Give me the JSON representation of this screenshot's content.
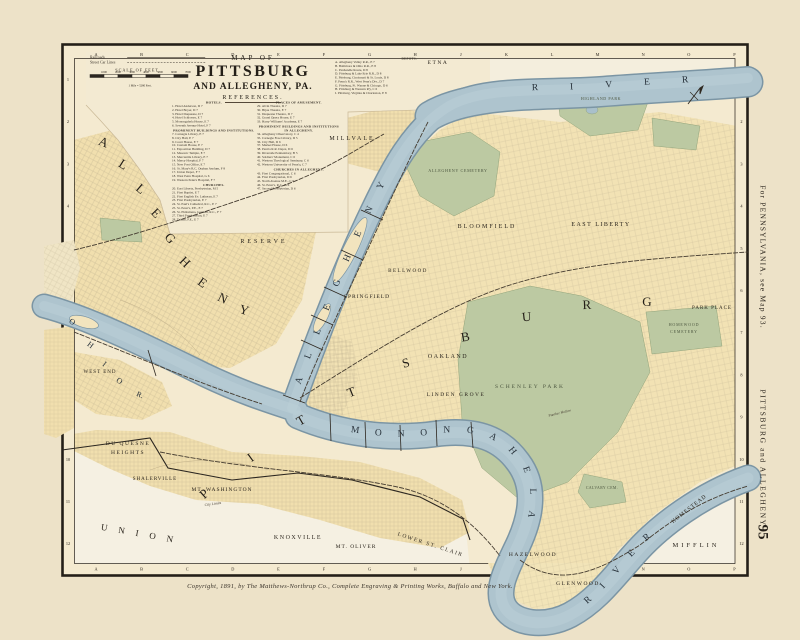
{
  "page": {
    "number": "95",
    "side_note_top": "For PENNSYLVANIA, see Map 93.",
    "side_note_bottom": "PITTSBURG and ALLEGHENY",
    "copyright": "Copyright, 1891, by The Matthews-Northrup Co., Complete Engraving & Printing Works, Buffalo and New York."
  },
  "title": {
    "line1": "MAP OF",
    "line2": "PITTSBURG",
    "line3": "AND ALLEGHENY, PA.",
    "line4": "REFERENCES."
  },
  "legend": {
    "railroads": "Railroads",
    "street_car_lines": "Street Car Lines",
    "scale_title": "SCALE OF FEET.",
    "scale_note": "1 Mile = 5280 Feet.",
    "scale_ticks": [
      "1000",
      "2000",
      "3000",
      "4000",
      "5000",
      "6000",
      "7000"
    ]
  },
  "grid": {
    "columns": [
      "A",
      "B",
      "C",
      "D",
      "E",
      "F",
      "G",
      "H",
      "J",
      "K",
      "L",
      "M",
      "N",
      "O",
      "P"
    ],
    "rows": [
      "1",
      "2",
      "3",
      "4",
      "5",
      "6",
      "7",
      "8",
      "9",
      "10",
      "11",
      "12"
    ]
  },
  "rivers": {
    "allegheny": "ALLEGHENY",
    "allegheny_river": "RIVER",
    "monongahela": "MONONGAHELA",
    "monongahela_river": "RIVER"
  },
  "references": {
    "hotels": {
      "header": "HOTELS.",
      "items": [
        "1. Hotel Anderson, D 7",
        "2. Hotel Boyer, D 7",
        "3. Hotel Duquesne, D 7",
        "4. Hotel Schlosser, E 7",
        "5. Monongahela House, E 7",
        "6. Seventh Avenue Hotel, F 7"
      ]
    },
    "prominent": {
      "header": "PROMINENT BUILDINGS AND INSTITUTIONS.",
      "items": [
        "7. Carnegie Library, E 7",
        "8. City Hall, E 7",
        "9. Court House, E 7",
        "10. Custom House, E 7",
        "11. Exposition Building, D 7",
        "12. Masonic Temple, E 7",
        "13. Mercantile Library, E 7",
        "14. Mercy Hospital, F 7",
        "15. New Post Office, E 7",
        "16. St. Mary's R.C. Orphan Asylum, F 8",
        "17. Union Depot, F 7",
        "18. West Penn Hospital, G 6",
        "19. Western Penn'a Hospital, F 7"
      ]
    },
    "churches": {
      "header": "CHURCHES.",
      "items": [
        "20. East Liberty, Presbyterian, M 5",
        "21. First Baptist, E 7",
        "22. First English Ev. Lutheran, E 7",
        "23. First Presbyterian, E 7",
        "24. St. Paul's Cathedral, R.C., E 7",
        "25. St. Peter's, P.E., E 7",
        "26. St. Philomena, German, R.C., F 7",
        "27. Third Presbyterian, E 7",
        "28. Trinity, P.E., E 7"
      ]
    },
    "amusement": {
      "header": "PLACES OF AMUSEMENT.",
      "items": [
        "29. Alvin Theatre, D 7",
        "30. Bijou Theatre, E 7",
        "31. Duquesne Theatre, D 7",
        "32. Grand Opera House, E 7",
        "33. Harry Williams' Academy, E 7"
      ]
    },
    "prominent_allegheny": {
      "header": "PROMINENT BUILDINGS AND INSTITUTIONS IN ALLEGHENY.",
      "items": [
        "34. Allegheny Observatory, C 4",
        "35. Carnegie Free Library, D 5",
        "36. City Hall, D 6",
        "37. Market House, D 6",
        "38. Penn'a R.R. Depot, D 6",
        "39. Riverside Penitentiary, B 5",
        "40. Soldiers' Monument, C 6",
        "41. Western Theological Seminary, C 6",
        "42. Western University of Penn'a, C 7"
      ]
    },
    "churches_allegheny": {
      "header": "CHURCHES IN ALLEGHENY.",
      "items": [
        "43. First Congregational, C 6",
        "44. First Presbyterian, D 6",
        "45. North Avenue M.E., C 6",
        "46. St. Peter's, R.C., D 6",
        "47. Second Presbyterian, D 6"
      ]
    },
    "depots": {
      "header": "DEPOTS.",
      "items": [
        "A. Allegheny Valley R.R., E 7",
        "B. Baltimore & Ohio R.R., E 8",
        "C. Panhandle Route, D 8",
        "D. Pittsburg & Lake Erie R.R., D 8",
        "E. Pittsburg, Cincinnati & St. Louis, D 8",
        "F. Penn'a R.R., West Penn'a Div., D 7",
        "G. Pittsburg, Ft. Wayne & Chicago, D 6",
        "H. Pittsburg & Western R'y, C 6",
        "I. Pittsburg, Virginia & Charleston, E 8"
      ]
    }
  },
  "map_labels": [
    {
      "t": "ETNA",
      "x": 438,
      "y": 64,
      "s": 5.5,
      "ls": 1.5
    },
    {
      "t": "MILLVALE",
      "x": 352,
      "y": 140,
      "s": 6,
      "ls": 2
    },
    {
      "t": "RESERVE",
      "x": 264,
      "y": 243,
      "s": 6,
      "ls": 3
    },
    {
      "t": "BELLWOOD",
      "x": 408,
      "y": 272,
      "s": 5,
      "ls": 1.5
    },
    {
      "t": "SPRINGFIELD",
      "x": 367,
      "y": 298,
      "s": 5.5,
      "ls": 1
    },
    {
      "t": "BLOOMFIELD",
      "x": 487,
      "y": 228,
      "s": 6,
      "ls": 2
    },
    {
      "t": "EAST LIBERTY",
      "x": 601,
      "y": 226,
      "s": 6,
      "ls": 1.5
    },
    {
      "t": "PARK PLACE",
      "x": 712,
      "y": 309,
      "s": 5,
      "ls": 1
    },
    {
      "t": "OAKLAND",
      "x": 448,
      "y": 358,
      "s": 6,
      "ls": 1.5
    },
    {
      "t": "LINDEN GROVE",
      "x": 456,
      "y": 396,
      "s": 5.5,
      "ls": 1.5
    },
    {
      "t": "HAZELWOOD",
      "x": 533,
      "y": 556,
      "s": 5.5,
      "ls": 1.5
    },
    {
      "t": "GLENWOOD",
      "x": 578,
      "y": 585,
      "s": 5.5,
      "ls": 1.5
    },
    {
      "t": "HOMESTEAD",
      "x": 690,
      "y": 510,
      "s": 5.5,
      "ls": 1,
      "r": -38
    },
    {
      "t": "MIFFLIN",
      "x": 696,
      "y": 547,
      "s": 6.5,
      "ls": 3
    },
    {
      "t": "KNOXVILLE",
      "x": 298,
      "y": 539,
      "s": 6,
      "ls": 1.5
    },
    {
      "t": "MT. OLIVER",
      "x": 356,
      "y": 548,
      "s": 5.5,
      "ls": 1
    },
    {
      "t": "LOWER ST. CLAIR",
      "x": 430,
      "y": 546,
      "s": 5.5,
      "ls": 1.5,
      "r": 18
    },
    {
      "t": "WEST END",
      "x": 100,
      "y": 373,
      "s": 5,
      "ls": 1
    },
    {
      "t": "DU QUESNE",
      "x": 128,
      "y": 445,
      "s": 5.5,
      "ls": 1.5
    },
    {
      "t": "HEIGHTS",
      "x": 128,
      "y": 454,
      "s": 5.5,
      "ls": 1.5
    },
    {
      "t": "SHALERVILLE",
      "x": 155,
      "y": 480,
      "s": 5,
      "ls": 1
    },
    {
      "t": "MT. WASHINGTON",
      "x": 222,
      "y": 491,
      "s": 5.5,
      "ls": 1
    },
    {
      "t": "UNION",
      "x": 142,
      "y": 537,
      "s": 9,
      "ls": 11,
      "r": 10
    },
    {
      "t": "City Limits",
      "x": 213,
      "y": 505,
      "s": 3.8,
      "r": -8,
      "c": "i"
    },
    {
      "t": "Panther Hollow",
      "x": 560,
      "y": 414,
      "s": 3.6,
      "r": -14,
      "c": "i"
    },
    {
      "t": "ALLEGHENY CEMETERY",
      "x": 458,
      "y": 172,
      "s": 4.2,
      "ls": 0.6,
      "c": "p"
    },
    {
      "t": "SCHENLEY PARK",
      "x": 530,
      "y": 388,
      "s": 5.5,
      "ls": 2,
      "c": "p"
    },
    {
      "t": "HOMEWOOD",
      "x": 684,
      "y": 326,
      "s": 4,
      "ls": 0.8,
      "c": "p"
    },
    {
      "t": "CEMETERY",
      "x": 684,
      "y": 333,
      "s": 4,
      "ls": 0.8,
      "c": "p"
    },
    {
      "t": "HIGHLAND PARK",
      "x": 601,
      "y": 100,
      "s": 4,
      "ls": 0.6,
      "c": "p"
    },
    {
      "t": "CALVARY CEM.",
      "x": 602,
      "y": 489,
      "s": 3.8,
      "ls": 0.4,
      "c": "p"
    },
    {
      "t": "P",
      "x": 207,
      "y": 497,
      "s": 13,
      "r": -42,
      "c": "b"
    },
    {
      "t": "I",
      "x": 253,
      "y": 461,
      "s": 13,
      "r": -36,
      "c": "b"
    },
    {
      "t": "T",
      "x": 303,
      "y": 424,
      "s": 13,
      "r": -30,
      "c": "b"
    },
    {
      "t": "T",
      "x": 353,
      "y": 396,
      "s": 13,
      "r": -22,
      "c": "b"
    },
    {
      "t": "S",
      "x": 407,
      "y": 367,
      "s": 13,
      "r": -16,
      "c": "b"
    },
    {
      "t": "B",
      "x": 466,
      "y": 341,
      "s": 13,
      "r": -10,
      "c": "b"
    },
    {
      "t": "U",
      "x": 527,
      "y": 321,
      "s": 13,
      "r": -6,
      "c": "b"
    },
    {
      "t": "R",
      "x": 587,
      "y": 309,
      "s": 13,
      "r": -2,
      "c": "b"
    },
    {
      "t": "G",
      "x": 647,
      "y": 306,
      "s": 13,
      "c": "b"
    },
    {
      "t": "A",
      "x": 102,
      "y": 146,
      "s": 10.5,
      "r": 22,
      "c": "b"
    },
    {
      "t": "L",
      "x": 121,
      "y": 168,
      "s": 10.5,
      "r": 32,
      "c": "b"
    },
    {
      "t": "L",
      "x": 138,
      "y": 192,
      "s": 10.5,
      "r": 40,
      "c": "b"
    },
    {
      "t": "E",
      "x": 153,
      "y": 216,
      "s": 10.5,
      "r": 46,
      "c": "b"
    },
    {
      "t": "G",
      "x": 167,
      "y": 241,
      "s": 10.5,
      "r": 48,
      "c": "b"
    },
    {
      "t": "H",
      "x": 182,
      "y": 265,
      "s": 10.5,
      "r": 44,
      "c": "b"
    },
    {
      "t": "E",
      "x": 200,
      "y": 286,
      "s": 10.5,
      "r": 36,
      "c": "b"
    },
    {
      "t": "N",
      "x": 221,
      "y": 302,
      "s": 10.5,
      "r": 26,
      "c": "b"
    },
    {
      "t": "Y",
      "x": 243,
      "y": 314,
      "s": 10.5,
      "r": 16,
      "c": "b"
    },
    {
      "t": "O",
      "x": 71,
      "y": 324,
      "s": 8,
      "r": 30,
      "c": "rv"
    },
    {
      "t": "H",
      "x": 89,
      "y": 347,
      "s": 8,
      "r": 36,
      "c": "rv"
    },
    {
      "t": "I",
      "x": 103,
      "y": 366,
      "s": 8,
      "r": 38,
      "c": "rv"
    },
    {
      "t": "O",
      "x": 118,
      "y": 383,
      "s": 8,
      "r": 34,
      "c": "rv"
    },
    {
      "t": "R.",
      "x": 139,
      "y": 397,
      "s": 7.5,
      "r": 24,
      "c": "rv"
    }
  ]
}
